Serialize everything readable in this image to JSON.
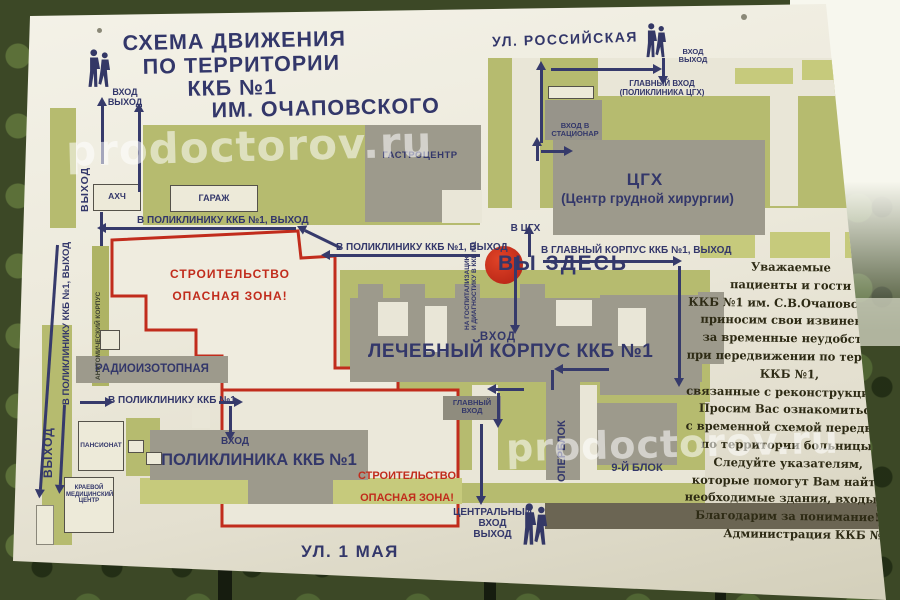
{
  "colors": {
    "navy": "#33376a",
    "red": "#c12c1c",
    "map_green": "#b6bb6f",
    "building_gray": "#9d9a8c",
    "board_cream": "#ece9db",
    "notice_text": "#2d2a14",
    "marker_red": "#c8311c"
  },
  "watermark": "prodoctorov.ru",
  "title": {
    "lines": [
      "СХЕМА ДВИЖЕНИЯ",
      "ПО ТЕРРИТОРИИ",
      "ККБ №1",
      "ИМ. ОЧАПОВСКОГО"
    ]
  },
  "streets": {
    "top": "УЛ. РОССИЙСКАЯ",
    "bottom": "УЛ. 1 МАЯ"
  },
  "marker": {
    "you_are_here": "ВЫ ЗДЕСЬ"
  },
  "buildings": {
    "gastro": "ГАСТРОЦЕНТР",
    "garage": "ГАРАЖ",
    "ahch": "АХЧ",
    "cgh_abbr": "ЦГХ",
    "cgh_full": "(Центр грудной хирургии)",
    "med_corpus": "ЛЕЧЕБНЫЙ КОРПУС ККБ №1",
    "polyclinic": "ПОЛИКЛИНИКА ККБ №1",
    "radioisotope": "РАДИОИЗОТОПНАЯ",
    "pansionat": "ПАНСИОНАТ",
    "regional_med_center": "КРАЕВОЙ МЕДИЦИНСКИЙ ЦЕНТР",
    "block9": "9-Й БЛОК",
    "operblock": "ОПЕРБЛОК",
    "anatomy": "АНАТОМИЧЕСКИЙ КОРПУС"
  },
  "labels": {
    "entrance": "ВХОД",
    "exit": "ВЫХОД",
    "central": "ЦЕНТРАЛЬНЫЙ",
    "to_polyclinic_exit": "В ПОЛИКЛИНИКУ ККБ №1, ВЫХОД",
    "to_polyclinic": "В ПОЛИКЛИНИКУ ККБ №1",
    "to_cgh": "В ЦГХ",
    "to_main_corpus_exit": "В ГЛАВНЫЙ КОРПУС ККБ №1, ВЫХОД",
    "main_entrance": "ГЛАВНЫЙ ВХОД",
    "cgh_polyclinic": "(ПОЛИКЛИНИКА ЦГХ)",
    "stationar_entrance": "ВХОД В СТАЦИОНАР",
    "hospitalization_l1": "НА ГОСПИТАЛИЗАЦИЮ",
    "hospitalization_l2": "И ДИАГНОСТИКУ В ККБ №1"
  },
  "construction": {
    "l1": "СТРОИТЕЛЬСТВО",
    "l2": "ОПАСНАЯ ЗОНА!"
  },
  "notice": {
    "lines": [
      "Уважаемые",
      "пациенты и гости",
      "ККБ №1 им. С.В.Очаповского,",
      "приносим свои извинения",
      "за временные неудобства",
      "при передвижении по территории",
      "ККБ №1,",
      "связанные с реконструкцией больницы.",
      "Просим Вас ознакомиться",
      "с временной схемой передвижения",
      "по территории больницы.",
      "Следуйте указателям,",
      "которые помогут Вам найти",
      "необходимые здания, входы, выходы.",
      "Благодарим за понимание!",
      "Администрация ККБ №1"
    ]
  }
}
